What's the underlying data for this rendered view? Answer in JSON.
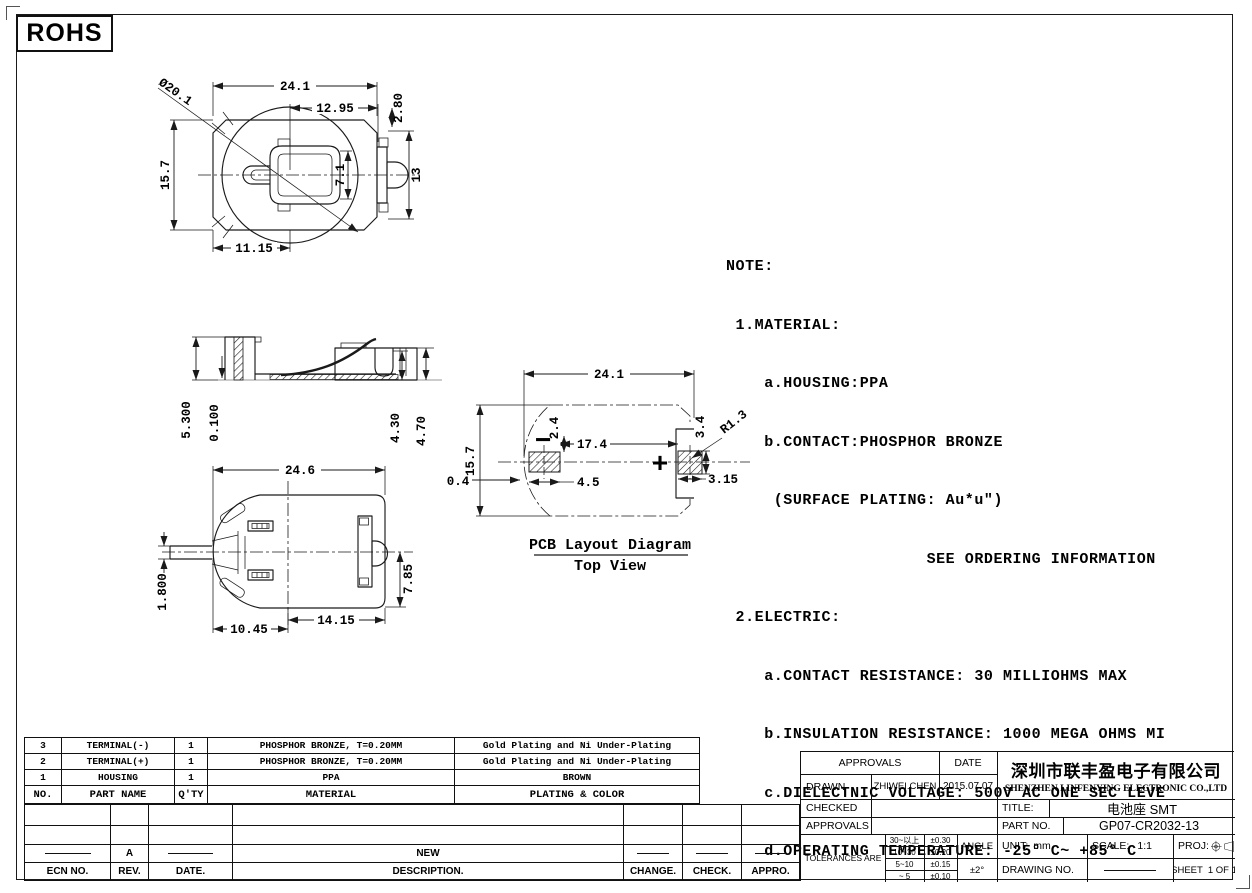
{
  "colors": {
    "ink": "#1a1a1a",
    "paper": "#ffffff"
  },
  "rohs_label": "ROHS",
  "views": {
    "top": {
      "dims": {
        "battery_diameter": "Ø20.1",
        "overall_width": "24.1",
        "right_offset": "12.95",
        "tab_height": "2.80",
        "right_height": "13",
        "overall_height": "15.7",
        "inner_height": "7.1",
        "left_offset": "11.15"
      }
    },
    "side": {
      "dims": {
        "total_height": "5.300",
        "base_thickness": "0.100",
        "inner_height": "4.30",
        "outer_height": "4.70"
      }
    },
    "bottom": {
      "dims": {
        "overall_width": "24.6",
        "pin_width": "1.800",
        "left_span": "10.45",
        "right_span": "14.15",
        "right_offset": "7.85"
      }
    },
    "pcb": {
      "caption_title": "PCB Layout Diagram",
      "caption_subtitle": "Top View",
      "minus": "−",
      "plus": "+",
      "dims": {
        "overall_width": "24.1",
        "overall_height": "15.7",
        "edge_gap": "0.4",
        "pad_offset": "2.4",
        "pad_pitch": "17.4",
        "left_pad_width": "4.5",
        "right_pad_height": "3.4",
        "corner_radius": "R1.3",
        "right_pad_width": "3.15"
      }
    }
  },
  "note": {
    "lines": [
      "NOTE:",
      " 1.MATERIAL:",
      "    a.HOUSING:PPA",
      "    b.CONTACT:PHOSPHOR BRONZE",
      "     (SURFACE PLATING: Au*u″)",
      "                     SEE ORDERING INFORMATION",
      " 2.ELECTRIC:",
      "    a.CONTACT RESISTANCE: 30 MILLIOHMS MAX",
      "    b.INSULATION RESISTANCE: 1000 MEGA OHMS MI",
      "    c.DIELECTNIC VOLTAGE: 500V AC ONE SEC LEVE",
      "    d.OPERATING TEMPERATURE: -25° C~ +85° C"
    ]
  },
  "bom": {
    "header": [
      "NO.",
      "PART NAME",
      "Q'TY",
      "MATERIAL",
      "PLATING & COLOR"
    ],
    "rows": [
      [
        "3",
        "TERMINAL(-)",
        "1",
        "PHOSPHOR BRONZE, T=0.20MM",
        "Gold Plating and Ni Under-Plating"
      ],
      [
        "2",
        "TERMINAL(+)",
        "1",
        "PHOSPHOR BRONZE, T=0.20MM",
        "Gold Plating and Ni Under-Plating"
      ],
      [
        "1",
        "HOUSING",
        "1",
        "PPA",
        "BROWN"
      ]
    ]
  },
  "revision": {
    "header": [
      "ECN NO.",
      "REV.",
      "DATE.",
      "DESCRIPTION.",
      "CHANGE.",
      "CHECK.",
      "APPRO."
    ],
    "entry": {
      "rev": "A",
      "description": "NEW"
    }
  },
  "title_block": {
    "approvals_header": "APPROVALS",
    "date_header": "DATE",
    "drawn_label": "DRAWN",
    "drawn_by": "ZHIWEI.CHEN",
    "drawn_date": "2015.07.07",
    "checked_label": "CHECKED",
    "approvals_label": "APPROVALS",
    "company_cn": "深圳市联丰盈电子有限公司",
    "company_en": "SHENZHEN LINFENYING ELECTRONIC CO.,LTD",
    "title_label": "TITLE:",
    "title_value": "电池座 SMT",
    "part_no_label": "PART NO.",
    "part_no_value": "GP07-CR2032-13",
    "tolerances_label": "TOLERANCES ARE",
    "tolerances": [
      {
        "range": "30~以上",
        "tol": "±0.30"
      },
      {
        "range": "10~30",
        "tol": "±0.20"
      },
      {
        "range": "5~10",
        "tol": "±0.15"
      },
      {
        "range": "~ 5",
        "tol": "±0.10"
      }
    ],
    "angle_label": "ANGLE",
    "angle_tol": "±2°",
    "unit_label": "UNIT:",
    "unit_value": "mm",
    "scale_label": "SCALE:",
    "scale_value": "1:1",
    "proj_label": "PROJ:",
    "drawing_no_label": "DRAWING NO.",
    "sheet_label": "SHEET",
    "sheet_value": "1 OF 1"
  }
}
